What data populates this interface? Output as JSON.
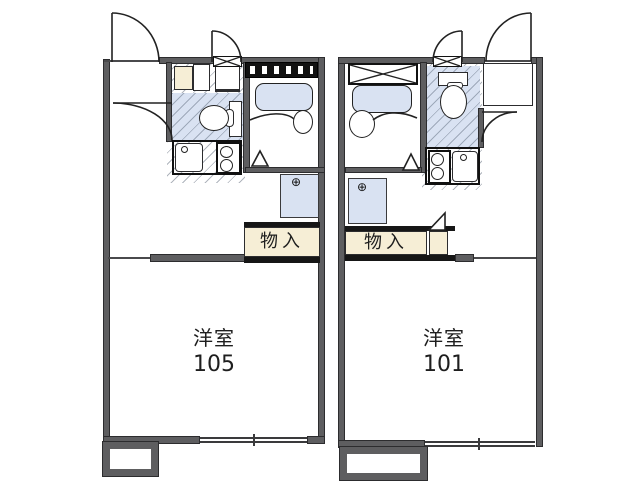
{
  "floorplan": {
    "units": [
      {
        "room_label": "洋室",
        "room_number": "105",
        "storage_label": "物入",
        "washer_symbol": "⊕"
      },
      {
        "room_label": "洋室",
        "room_number": "101",
        "storage_label": "物入",
        "washer_symbol": "⊕"
      }
    ],
    "colors": {
      "wall_gray": "#5e5e60",
      "fixture_blue": "#d9e2f2",
      "closet_cream": "#f6eed6",
      "bar_black": "#161616",
      "line_dark": "#222222"
    },
    "icons": {
      "washer_faucet": "circle-plus-faucet",
      "crossed_window": "x-window",
      "louver_window": "striped-louver-window"
    }
  }
}
